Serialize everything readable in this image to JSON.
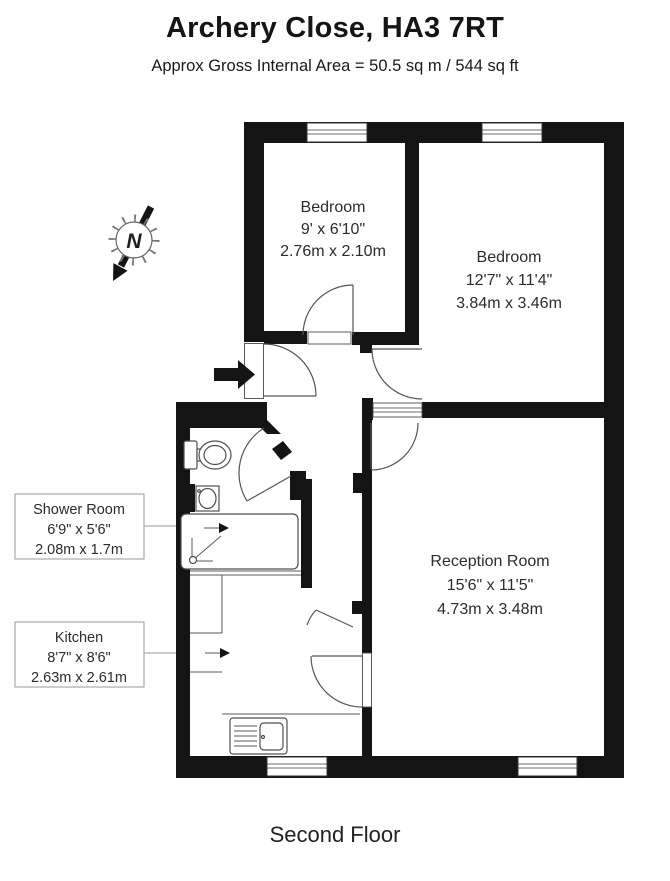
{
  "header": {
    "title": "Archery Close, HA3 7RT",
    "subtitle": "Approx Gross Internal Area = 50.5 sq m / 544 sq ft"
  },
  "floor_label": "Second Floor",
  "compass": {
    "letter": "N"
  },
  "rooms": {
    "bedroom1": {
      "name": "Bedroom",
      "imperial": "9' x 6'10\"",
      "metric": "2.76m x 2.10m"
    },
    "bedroom2": {
      "name": "Bedroom",
      "imperial": "12'7\" x 11'4\"",
      "metric": "3.84m x 3.46m"
    },
    "reception": {
      "name": "Reception Room",
      "imperial": "15'6\" x 11'5\"",
      "metric": "4.73m x 3.48m"
    },
    "shower": {
      "name": "Shower Room",
      "imperial": "6'9\" x 5'6\"",
      "metric": "2.08m x 1.7m"
    },
    "kitchen": {
      "name": "Kitchen",
      "imperial": "8'7\" x 8'6\"",
      "metric": "2.63m x 2.61m"
    }
  },
  "colors": {
    "wall": "#141414",
    "text": "#2c2c2c",
    "accent_line": "#555555"
  }
}
